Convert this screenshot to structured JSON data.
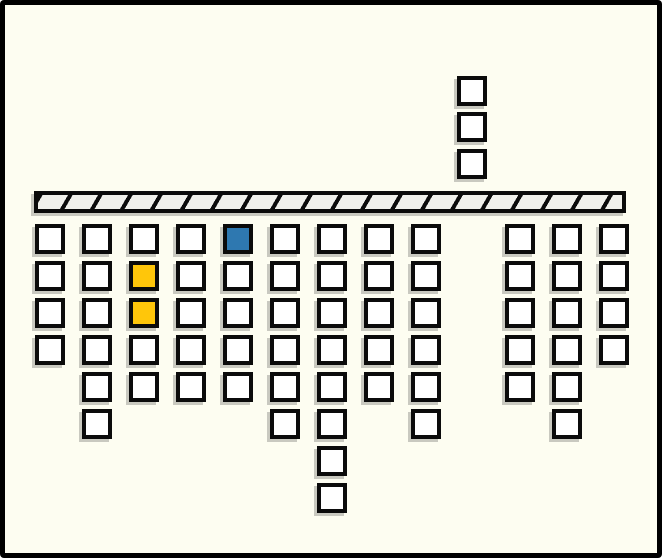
{
  "scene": {
    "description": "block-stack diagram: columns of outlined square blocks hanging below a hatched support bar, one highlighted blue block, two highlighted yellow blocks, and a stack of three blocks above the bar",
    "background": "#FDFDF1",
    "colors": {
      "outline": "#0b0b0b",
      "white": "#FFFFFF",
      "blue": "#2E78B0",
      "yellow": "#FFC60A",
      "bar_fill": "#F0F0EB",
      "shadow": "#C9C9C0",
      "frame_border": "#000000"
    },
    "frame_border_px": 5,
    "bar": {
      "x": 34,
      "y": 191,
      "width": 592,
      "height": 22,
      "hatch_step": 26,
      "hatch_line_px": 4
    },
    "grid": {
      "origin_y": 224,
      "cell_size": 30,
      "row_step": 37,
      "col_step": 47
    },
    "above_bar": {
      "x": 457,
      "ys": [
        76,
        112,
        149
      ],
      "cells": [
        "white",
        "white",
        "white"
      ]
    },
    "columns": [
      {
        "x": 35,
        "cells": [
          "white",
          "white",
          "white",
          "white"
        ]
      },
      {
        "x": 82,
        "cells": [
          "white",
          "white",
          "white",
          "white",
          "white",
          "white"
        ]
      },
      {
        "x": 129,
        "cells": [
          "white",
          "yellow",
          "yellow",
          "white",
          "white"
        ]
      },
      {
        "x": 176,
        "cells": [
          "white",
          "white",
          "white",
          "white",
          "white"
        ]
      },
      {
        "x": 223,
        "cells": [
          "blue",
          "white",
          "white",
          "white",
          "white"
        ]
      },
      {
        "x": 270,
        "cells": [
          "white",
          "white",
          "white",
          "white",
          "white",
          "white"
        ]
      },
      {
        "x": 317,
        "cells": [
          "white",
          "white",
          "white",
          "white",
          "white",
          "white",
          "white",
          "white"
        ]
      },
      {
        "x": 364,
        "cells": [
          "white",
          "white",
          "white",
          "white",
          "white"
        ]
      },
      {
        "x": 411,
        "cells": [
          "white",
          "white",
          "white",
          "white",
          "white",
          "white"
        ]
      },
      {
        "x": 505,
        "cells": [
          "white",
          "white",
          "white",
          "white",
          "white"
        ]
      },
      {
        "x": 552,
        "cells": [
          "white",
          "white",
          "white",
          "white",
          "white",
          "white"
        ]
      },
      {
        "x": 599,
        "cells": [
          "white",
          "white",
          "white",
          "white"
        ]
      }
    ]
  }
}
